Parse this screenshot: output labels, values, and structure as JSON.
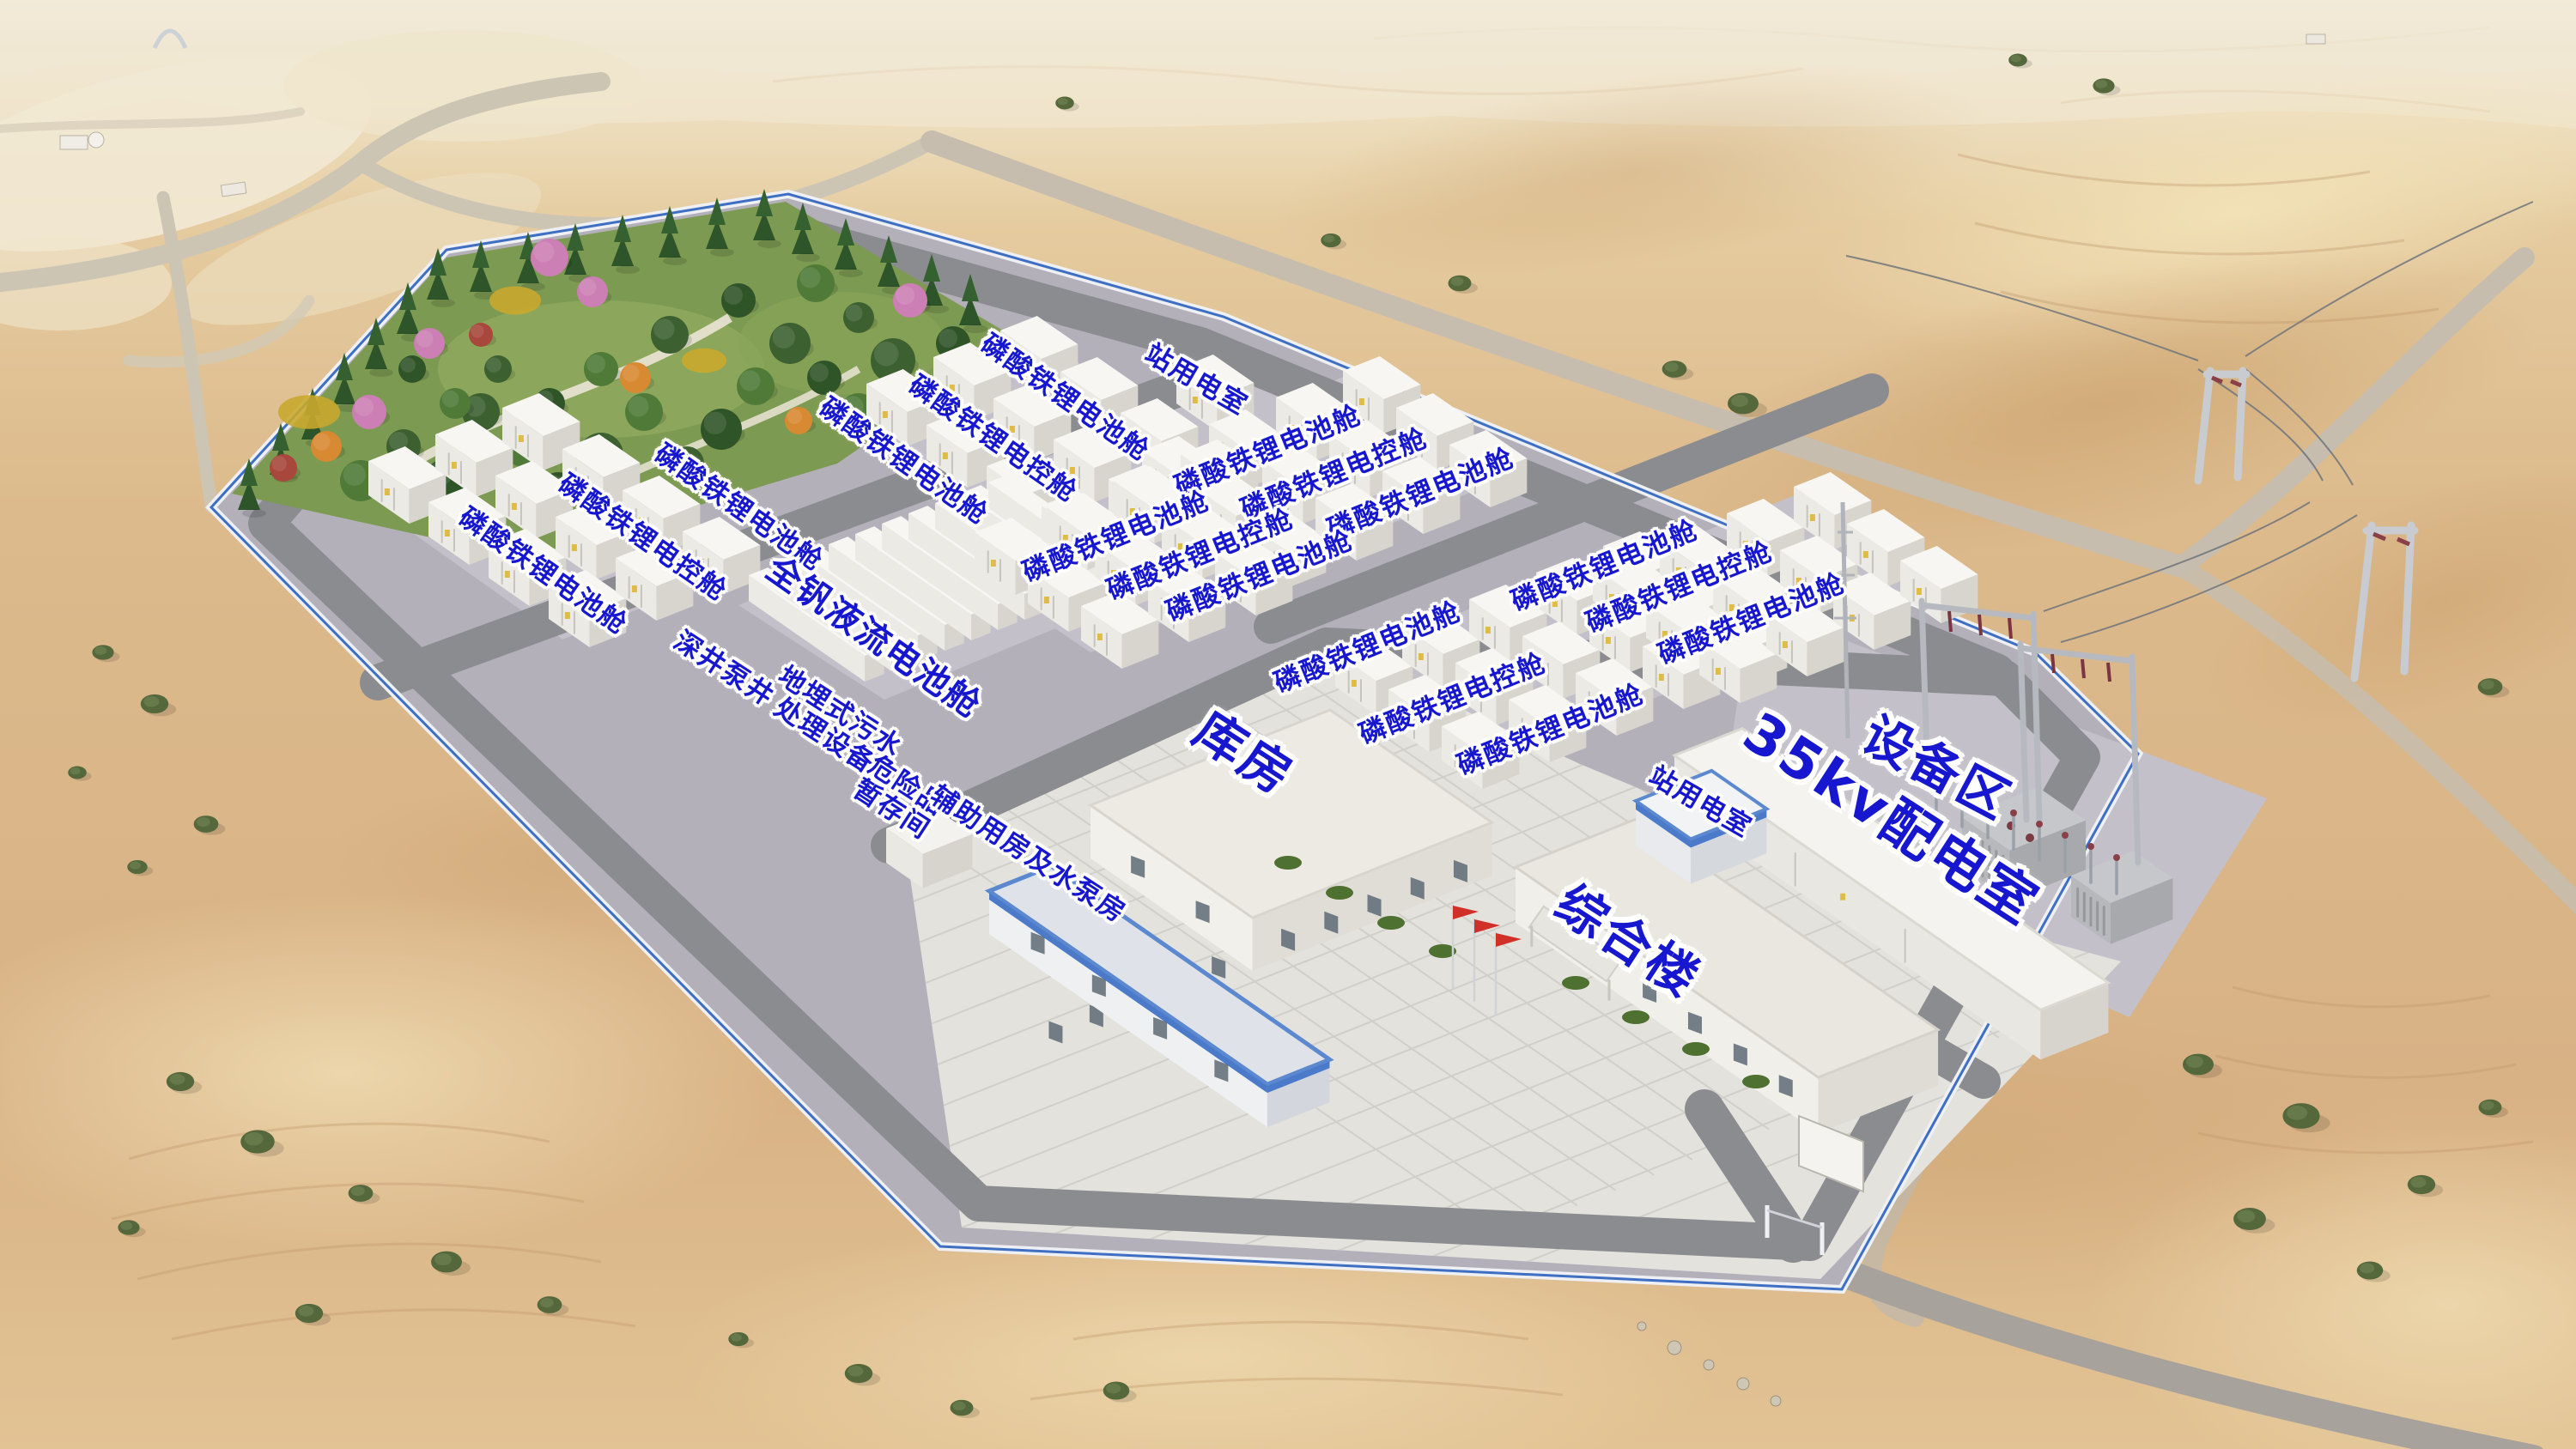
{
  "site_labels": [
    {
      "name": "lfp-battery-cabin-label",
      "text": "磷酸铁锂电池舱",
      "x": 41.33,
      "y": 27.49,
      "rot": 35,
      "size": "sm"
    },
    {
      "name": "lfp-control-cabin-label",
      "text": "磷酸铁锂电控舱",
      "x": 38.53,
      "y": 30.33,
      "rot": 35,
      "size": "sm"
    },
    {
      "name": "lfp-battery-cabin-label",
      "text": "磷酸铁锂电池舱",
      "x": 35.07,
      "y": 31.87,
      "rot": 35,
      "size": "sm"
    },
    {
      "name": "lfp-battery-cabin-label",
      "text": "磷酸铁锂电池舱",
      "x": 28.67,
      "y": 35.07,
      "rot": 35,
      "size": "sm"
    },
    {
      "name": "lfp-control-cabin-label",
      "text": "磷酸铁锂电控舱",
      "x": 24.93,
      "y": 37.14,
      "rot": 35,
      "size": "sm"
    },
    {
      "name": "lfp-battery-cabin-label",
      "text": "磷酸铁锂电池舱",
      "x": 21.07,
      "y": 39.45,
      "rot": 35,
      "size": "sm"
    },
    {
      "name": "station-power-room-label",
      "text": "站用电室",
      "x": 46.43,
      "y": 26.24,
      "rot": 30,
      "size": "sm"
    },
    {
      "name": "lfp-battery-cabin-label",
      "text": "磷酸铁锂电池舱",
      "x": 49.23,
      "y": 31.16,
      "rot": -22,
      "size": "sm"
    },
    {
      "name": "lfp-control-cabin-label",
      "text": "磷酸铁锂电控舱",
      "x": 51.8,
      "y": 32.76,
      "rot": -22,
      "size": "sm"
    },
    {
      "name": "lfp-battery-cabin-label",
      "text": "磷酸铁锂电池舱",
      "x": 55.17,
      "y": 34.12,
      "rot": -22,
      "size": "sm"
    },
    {
      "name": "lfp-battery-cabin-label",
      "text": "磷酸铁锂电池舱",
      "x": 43.33,
      "y": 37.09,
      "rot": -22,
      "size": "sm"
    },
    {
      "name": "lfp-control-cabin-label",
      "text": "磷酸铁锂电控舱",
      "x": 46.6,
      "y": 38.33,
      "rot": -22,
      "size": "sm"
    },
    {
      "name": "lfp-battery-cabin-label",
      "text": "磷酸铁锂电池舱",
      "x": 48.9,
      "y": 39.81,
      "rot": -22,
      "size": "sm"
    },
    {
      "name": "lfp-battery-cabin-label",
      "text": "磷酸铁锂电池舱",
      "x": 62.3,
      "y": 39.1,
      "rot": -22,
      "size": "sm"
    },
    {
      "name": "lfp-control-cabin-label",
      "text": "磷酸铁锂电控舱",
      "x": 65.2,
      "y": 40.58,
      "rot": -22,
      "size": "sm"
    },
    {
      "name": "lfp-battery-cabin-label",
      "text": "磷酸铁锂电池舱",
      "x": 68.0,
      "y": 42.77,
      "rot": -22,
      "size": "sm"
    },
    {
      "name": "lfp-battery-cabin-label",
      "text": "磷酸铁锂电池舱",
      "x": 53.1,
      "y": 44.73,
      "rot": -22,
      "size": "sm"
    },
    {
      "name": "lfp-control-cabin-label",
      "text": "磷酸铁锂电控舱",
      "x": 56.4,
      "y": 48.28,
      "rot": -22,
      "size": "sm"
    },
    {
      "name": "lfp-battery-cabin-label",
      "text": "磷酸铁锂电池舱",
      "x": 60.2,
      "y": 50.41,
      "rot": -22,
      "size": "sm"
    },
    {
      "name": "vanadium-flow-battery-label",
      "text": "全钒液流电池舱",
      "x": 33.9,
      "y": 44.02,
      "rot": 35,
      "size": "md"
    },
    {
      "name": "deep-well-pump-label",
      "text": "深井泵井",
      "x": 28.1,
      "y": 46.21,
      "rot": 33,
      "size": "sm"
    },
    {
      "name": "buried-sewage-treatment-label",
      "text": "地埋式污水\n处理设备",
      "x": 32.3,
      "y": 50.0,
      "rot": 33,
      "size": "sm"
    },
    {
      "name": "hazmat-storage-label",
      "text": "危险品\n暂存间",
      "x": 34.9,
      "y": 55.09,
      "rot": 33,
      "size": "sm"
    },
    {
      "name": "auxiliary-pump-house-label",
      "text": "辅助用房及水泵房",
      "x": 39.9,
      "y": 59.0,
      "rot": 33,
      "size": "sm"
    },
    {
      "name": "warehouse-label",
      "text": "库房",
      "x": 48.3,
      "y": 52.0,
      "rot": 33,
      "size": "lg"
    },
    {
      "name": "complex-building-label",
      "text": "综合楼",
      "x": 63.2,
      "y": 64.99,
      "rot": 33,
      "size": "lg"
    },
    {
      "name": "station-power-room-label",
      "text": "站用电室",
      "x": 66.0,
      "y": 55.4,
      "rot": 30,
      "size": "sm"
    },
    {
      "name": "distribution-room-35kv-label",
      "text": "35kv配电室",
      "x": 73.4,
      "y": 56.6,
      "rot": 33,
      "size": "xl"
    },
    {
      "name": "equipment-area-label",
      "text": "设备区",
      "x": 75.2,
      "y": 53.0,
      "rot": 28,
      "size": "lg"
    }
  ],
  "colors": {
    "label_blue": "#1717cf",
    "fence_blue": "#3e6fc2",
    "flag_red": "#d03028"
  }
}
